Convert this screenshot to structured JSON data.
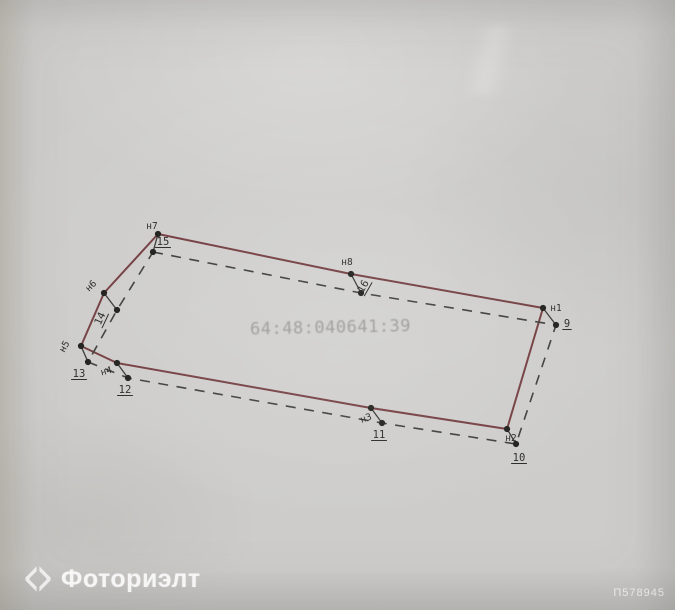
{
  "plan": {
    "cadastral_number": "64:48:040641:39",
    "cadastral_number_color": "#9c9c99",
    "outer_boundary": {
      "style": "solid",
      "color": "#764144",
      "points": [
        {
          "name": "н7",
          "x": 158,
          "y": 234,
          "label_x": 152,
          "label_y": 229,
          "rot": 0
        },
        {
          "name": "н8",
          "x": 351,
          "y": 274,
          "label_x": 347,
          "label_y": 265,
          "rot": 0
        },
        {
          "name": "н1",
          "x": 543,
          "y": 308,
          "label_x": 556,
          "label_y": 311,
          "rot": 0
        },
        {
          "name": "н2",
          "x": 507,
          "y": 429,
          "label_x": 511,
          "label_y": 441,
          "rot": 0
        },
        {
          "name": "н3",
          "x": 371,
          "y": 408,
          "label_x": 367,
          "label_y": 421,
          "rot": -20
        },
        {
          "name": "н4",
          "x": 117,
          "y": 363,
          "label_x": 107,
          "label_y": 374,
          "rot": -15
        },
        {
          "name": "н5",
          "x": 81,
          "y": 346,
          "label_x": 67,
          "label_y": 348,
          "rot": -60
        },
        {
          "name": "н6",
          "x": 104,
          "y": 293,
          "label_x": 93,
          "label_y": 288,
          "rot": -45
        }
      ]
    },
    "inner_boundary": {
      "style": "dashed",
      "color": "#41413e",
      "points": [
        {
          "name": "15",
          "x": 153,
          "y": 252,
          "label_x": 163,
          "label_y": 245,
          "rot": 0,
          "underline": true
        },
        {
          "name": "16",
          "x": 361,
          "y": 293,
          "label_x": 366,
          "label_y": 288,
          "rot": -60,
          "underline": true
        },
        {
          "name": "9",
          "x": 556,
          "y": 325,
          "label_x": 567,
          "label_y": 327,
          "rot": 0,
          "underline": true
        },
        {
          "name": "10",
          "x": 516,
          "y": 444,
          "label_x": 519,
          "label_y": 461,
          "rot": 0,
          "underline": true
        },
        {
          "name": "11",
          "x": 382,
          "y": 423,
          "label_x": 379,
          "label_y": 438,
          "rot": 0,
          "underline": true
        },
        {
          "name": "12",
          "x": 128,
          "y": 378,
          "label_x": 125,
          "label_y": 393,
          "rot": 0,
          "underline": true
        },
        {
          "name": "13",
          "x": 88,
          "y": 362,
          "label_x": 79,
          "label_y": 377,
          "rot": 0,
          "underline": true
        },
        {
          "name": "14",
          "x": 117,
          "y": 310,
          "label_x": 103,
          "label_y": 320,
          "rot": -65,
          "underline": true
        }
      ]
    },
    "pairs": [
      [
        "н7",
        "15"
      ],
      [
        "н8",
        "16"
      ],
      [
        "н1",
        "9"
      ],
      [
        "н2",
        "10"
      ],
      [
        "н3",
        "11"
      ],
      [
        "н4",
        "12"
      ],
      [
        "н5",
        "13"
      ],
      [
        "н6",
        "14"
      ]
    ],
    "point_color": "#22221f",
    "label_color": "#2d2d29",
    "leader_color": "#3b3b38"
  },
  "watermark": {
    "brand": "Фоториэлт",
    "logo": "diamond-chevrons-icon",
    "id_code": "П578945",
    "color": "#ffffff"
  }
}
